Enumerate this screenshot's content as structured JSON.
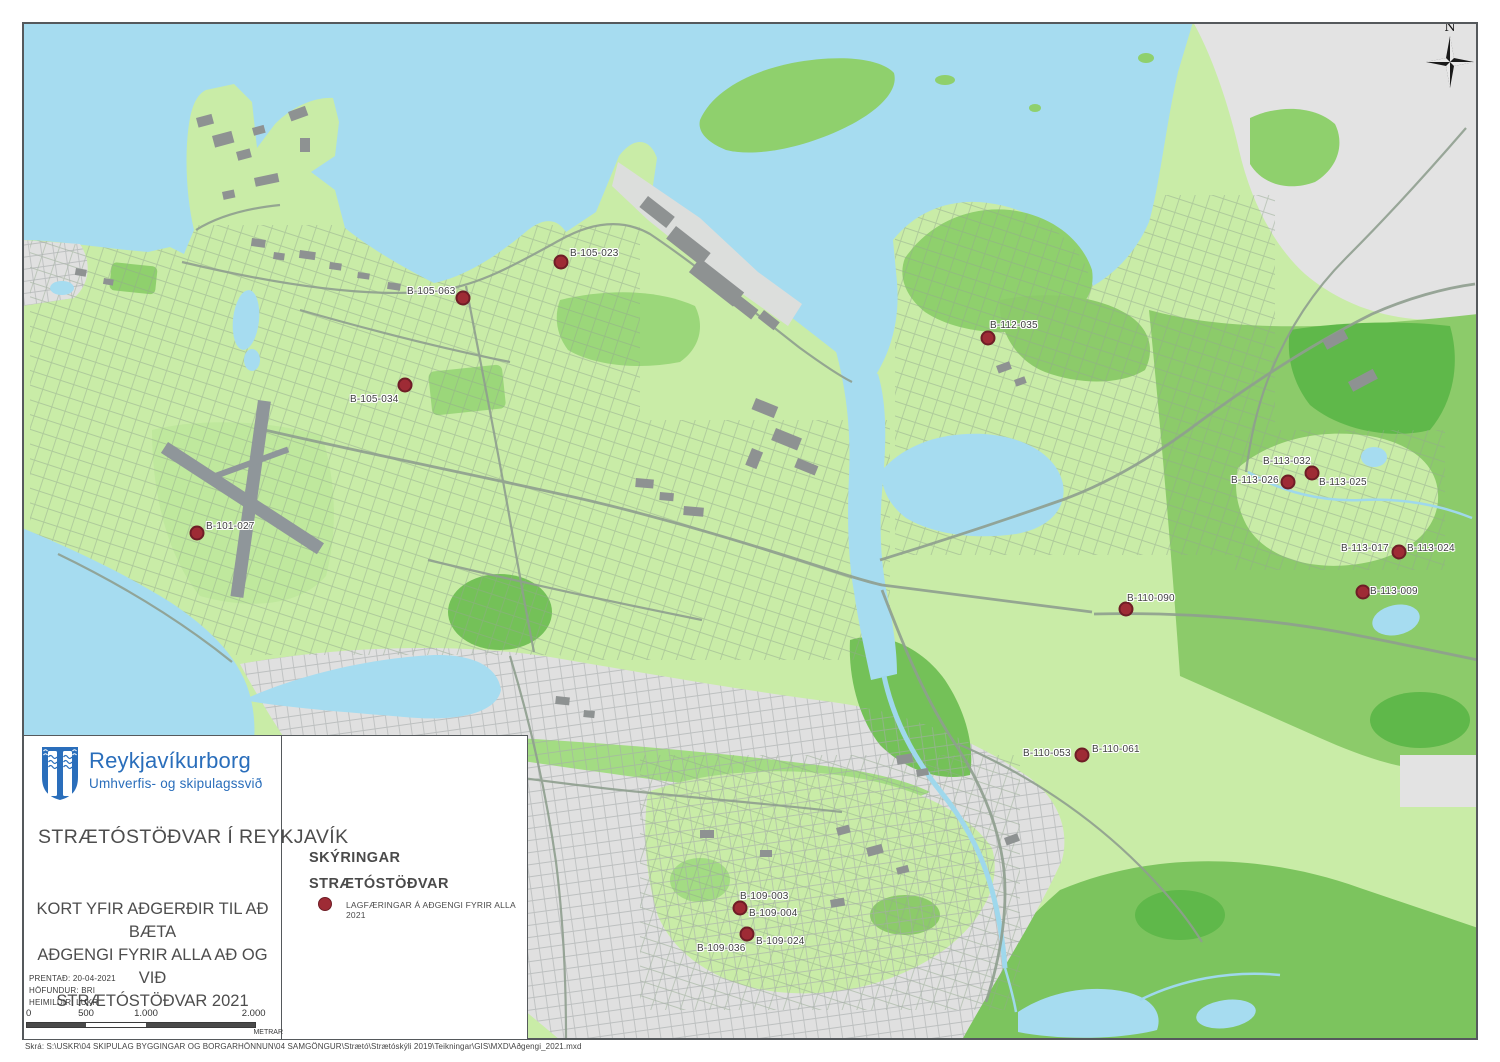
{
  "map": {
    "north_label": "N",
    "dot_color": "#9e2b35",
    "dot_edge_color": "#6e1d26",
    "dots": [
      [
        197,
        533
      ],
      [
        561,
        262
      ],
      [
        463,
        298
      ],
      [
        405,
        385
      ],
      [
        988,
        338
      ],
      [
        1312,
        473
      ],
      [
        1288,
        482
      ],
      [
        1399,
        552
      ],
      [
        1363,
        592
      ],
      [
        1126,
        609
      ],
      [
        1082,
        755
      ],
      [
        740,
        908
      ],
      [
        747,
        934
      ]
    ],
    "labels": [
      {
        "text": "B-101-027",
        "x": 206,
        "y": 521
      },
      {
        "text": "B-105-023",
        "x": 570,
        "y": 248
      },
      {
        "text": "B-105-063",
        "x": 407,
        "y": 286
      },
      {
        "text": "B-105-034",
        "x": 350,
        "y": 394
      },
      {
        "text": "B-112-035",
        "x": 990,
        "y": 320
      },
      {
        "text": "B-113-032",
        "x": 1263,
        "y": 456
      },
      {
        "text": "B-113-026",
        "x": 1231,
        "y": 475
      },
      {
        "text": "B-113-025",
        "x": 1319,
        "y": 477
      },
      {
        "text": "B-113-017",
        "x": 1341,
        "y": 543
      },
      {
        "text": "B-113-024",
        "x": 1407,
        "y": 543
      },
      {
        "text": "B-113-009",
        "x": 1370,
        "y": 586
      },
      {
        "text": "B-110-090",
        "x": 1127,
        "y": 593
      },
      {
        "text": "B-110-053",
        "x": 1023,
        "y": 748
      },
      {
        "text": "B-110-061",
        "x": 1092,
        "y": 744
      },
      {
        "text": "B-109-003",
        "x": 740,
        "y": 891
      },
      {
        "text": "B-109-004",
        "x": 749,
        "y": 908
      },
      {
        "text": "B-109-036",
        "x": 697,
        "y": 943
      },
      {
        "text": "B-109-024",
        "x": 756,
        "y": 936
      }
    ]
  },
  "info_panel": {
    "org_name": "Reykjavíkurborg",
    "org_dept": "Umhverfis- og skipulagssvið",
    "title": "STRÆTÓSTÖÐVAR Í REYKJAVÍK",
    "subtitle_lines": [
      "KORT YFIR AÐGERÐIR TIL AÐ BÆTA",
      "AÐGENGI FYRIR ALLA AÐ OG VIÐ",
      "STRÆTÓSTÖÐVAR 2021"
    ],
    "printed": "PRENTAÐ: 20-04-2021",
    "author": "HÖFUNDUR: BRI",
    "sources": "HEIMILDIR: LUKR",
    "scale_ticks": [
      "0",
      "500",
      "1.000",
      "2.000"
    ],
    "scale_unit": "METRAR"
  },
  "legend": {
    "heading": "SKÝRINGAR",
    "subheading": "STRÆTÓSTÖÐVAR",
    "items": [
      {
        "symbol": "dot",
        "label": "LAGFÆRINGAR Á AÐGENGI FYRIR ALLA 2021"
      }
    ]
  },
  "footer": {
    "file_path": "Skrá:  S:\\USKR\\04 SKIPULAG BYGGINGAR OG BORGARHÖNNUN\\04 SAMGÖNGUR\\Strætó\\Strætóskýli 2019\\Teikningar\\GIS\\MXD\\Aðgengi_2021.mxd"
  },
  "colors": {
    "water": "#a6dcf0",
    "land": "#c9eca7",
    "green_mid": "#8ccb6a",
    "green_dark": "#5fb84a",
    "urban_gray": "#e0e0e0",
    "building_gray": "#8e9292",
    "logo_blue": "#2a6ebb",
    "dot_red": "#9e2b35"
  }
}
